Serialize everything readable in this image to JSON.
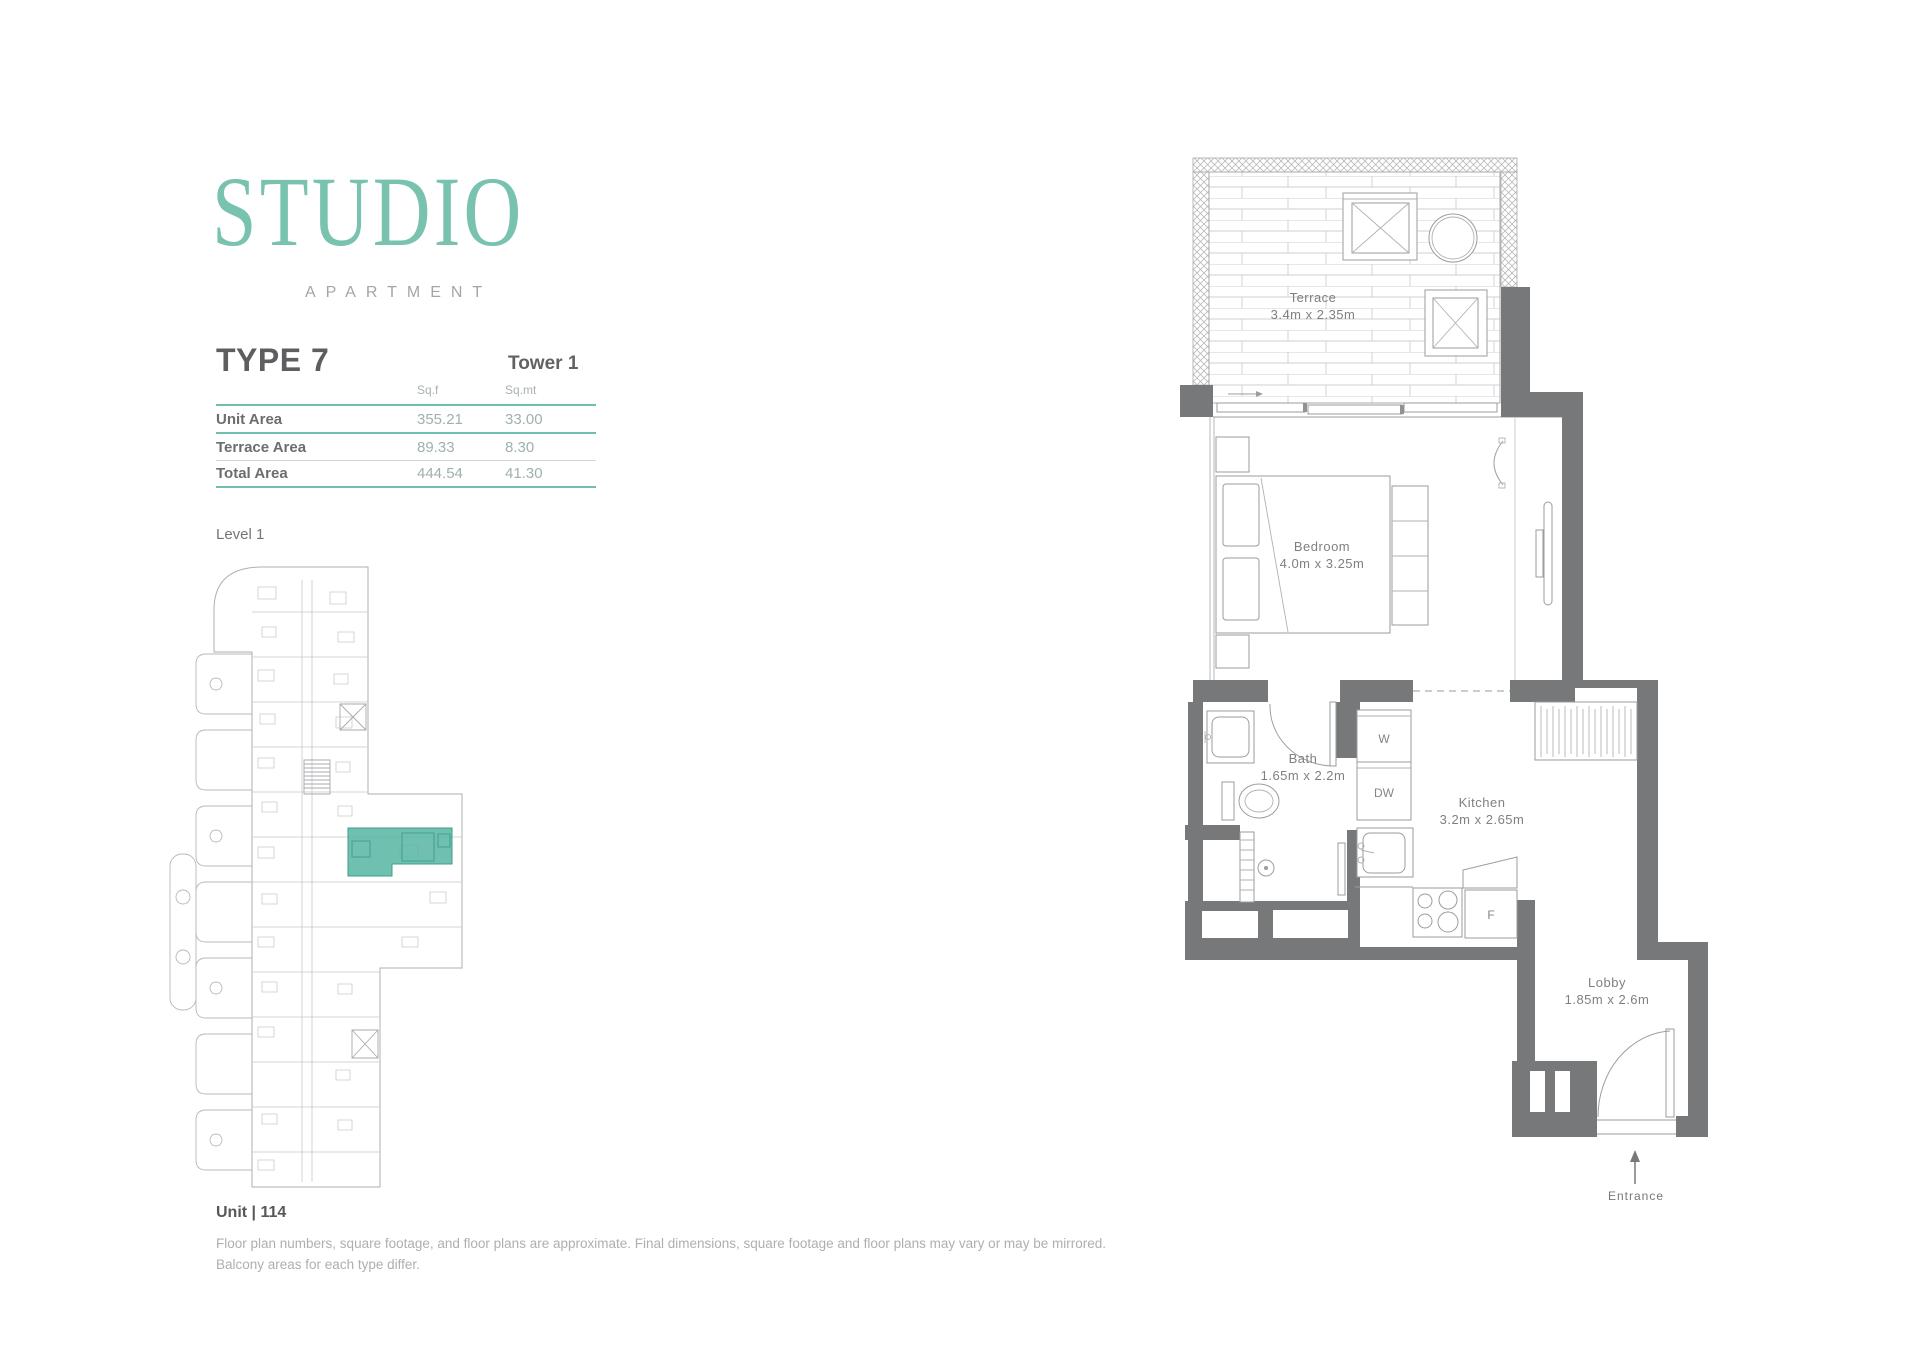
{
  "colors": {
    "accent_teal": "#6ec0ae",
    "logo_teal": "#79c2b0",
    "wall_gray": "#77787a",
    "highlight_teal": "#5bb7a4"
  },
  "logo": {
    "title": "STUDIO",
    "subtitle": "APARTMENT"
  },
  "header": {
    "type_title": "TYPE 7",
    "tower": "Tower 1"
  },
  "area_table": {
    "col_headers": [
      "Sq.f",
      "Sq.mt"
    ],
    "rows": [
      {
        "label": "Unit Area",
        "sqf": "355.21",
        "sqmt": "33.00"
      },
      {
        "label": "Terrace Area",
        "sqf": "89.33",
        "sqmt": "8.30"
      },
      {
        "label": "Total Area",
        "sqf": "444.54",
        "sqmt": "41.30"
      }
    ]
  },
  "key_plan": {
    "level_label": "Level 1",
    "unit_label": "Unit | 114"
  },
  "disclaimer": {
    "line1": "Floor plan numbers, square footage, and floor plans are approximate. Final dimensions, square footage and floor plans may vary or may be mirrored.",
    "line2": "Balcony areas for each type differ."
  },
  "floor_plan": {
    "rooms": [
      {
        "name": "Terrace",
        "dims": "3.4m x 2.35m"
      },
      {
        "name": "Bedroom",
        "dims": "4.0m x 3.25m"
      },
      {
        "name": "Bath",
        "dims": "1.65m x 2.2m"
      },
      {
        "name": "Kitchen",
        "dims": "3.2m x 2.65m"
      },
      {
        "name": "Lobby",
        "dims": "1.85m x 2.6m"
      }
    ],
    "appliances": {
      "washer": "W",
      "dishwasher": "DW",
      "fridge": "F"
    },
    "entrance_label": "Entrance"
  }
}
